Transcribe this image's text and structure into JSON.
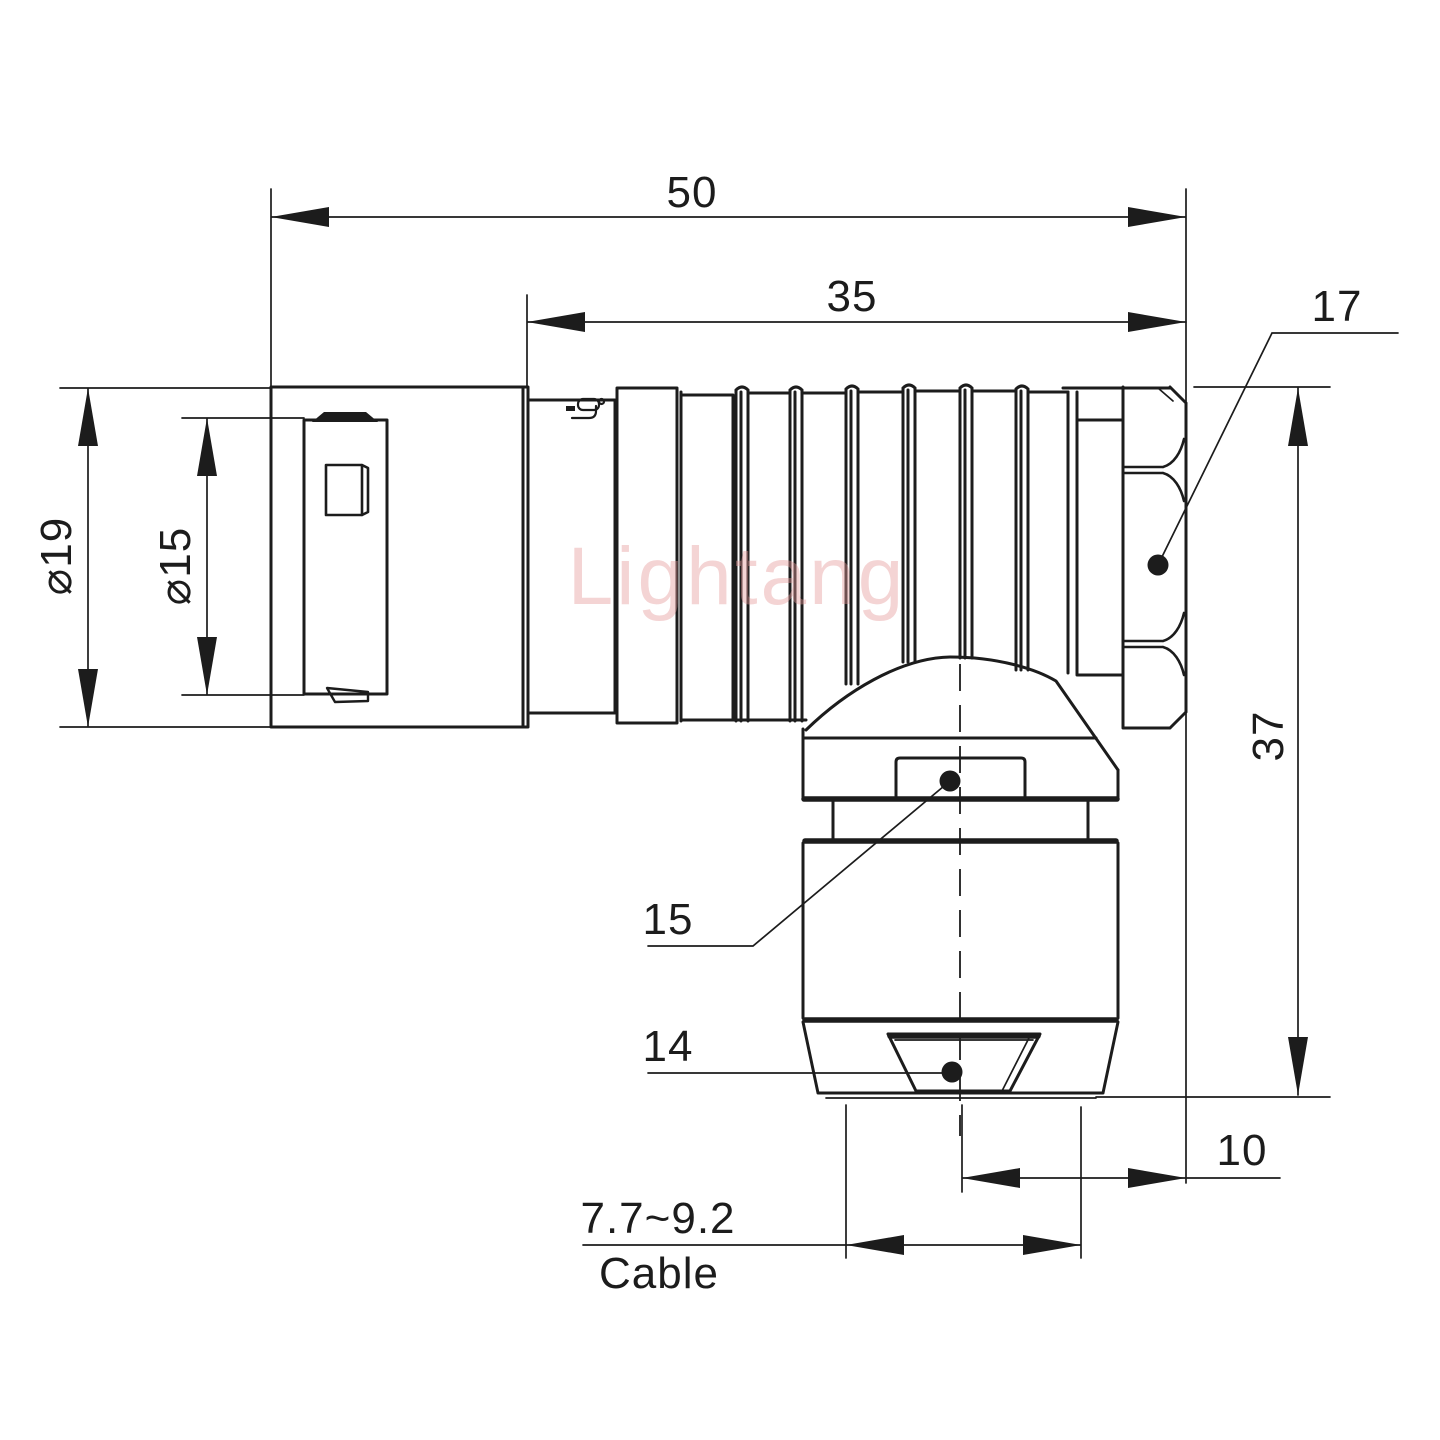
{
  "watermark": "Lightang",
  "dimensions": {
    "overall_length": "50",
    "body_length": "35",
    "hex_width": "17",
    "outer_diameter": "⌀19",
    "inner_diameter": "⌀15",
    "total_height": "37",
    "gland_nut": "15",
    "collet": "14",
    "offset": "10",
    "cable_range": "7.7~9.2",
    "cable_label": "Cable"
  }
}
